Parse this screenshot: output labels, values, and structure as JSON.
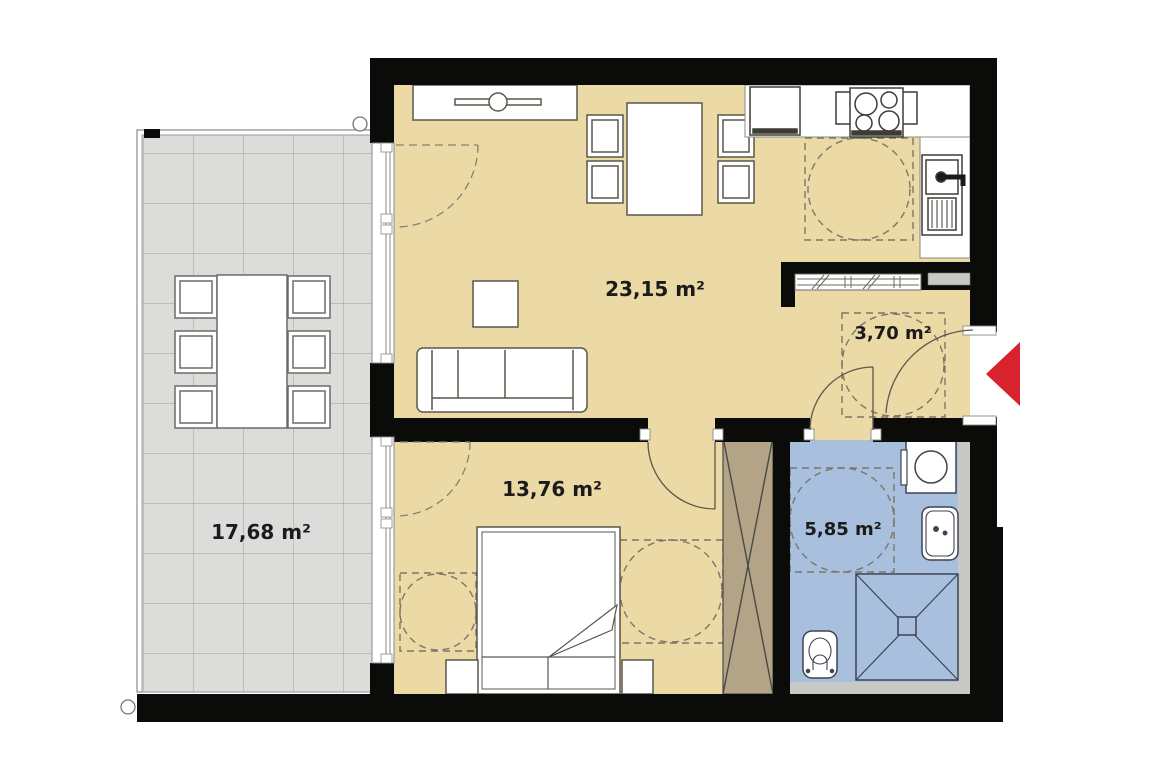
{
  "plan": {
    "type": "apartment-floor-plan",
    "unit_suffix": "m²",
    "rooms": [
      {
        "name": "living-room-kitchen",
        "label": "23,15 m²",
        "area": "23,15",
        "floor_color": "#EBD9A6"
      },
      {
        "name": "hallway",
        "label": "3,70 m²",
        "area": "3,70",
        "floor_color": "#EBD9A6"
      },
      {
        "name": "bedroom",
        "label": "13,76 m²",
        "area": "13,76",
        "floor_color": "#EBD9A6"
      },
      {
        "name": "bathroom",
        "label": "5,85 m²",
        "area": "5,85",
        "floor_color": "#A9BFDE"
      },
      {
        "name": "terrace",
        "label": "17,68 m²",
        "area": "17,68",
        "floor_color": "#DCDCDA"
      }
    ],
    "colors": {
      "walls": "#0B0B09",
      "floor_main": "#EBD9A6",
      "floor_bathroom": "#A9BFDE",
      "floor_terrace": "#DCDCDA",
      "wardrobe_fill": "#B3A488",
      "shaft_gray": "#C8C8C6",
      "entrance_arrow": "#D8232E"
    },
    "symbols": {
      "entrance": "red-arrow-pointing-left",
      "turning_circles_count": 5,
      "door_swings_count": 4
    },
    "furniture": [
      "closet-with-rod",
      "dining-table-4-chairs",
      "coffee-table",
      "sofa-3-seat",
      "fridge",
      "stove-4-burners",
      "kitchen-sink",
      "pass-through-window",
      "double-bed",
      "nightstand-left",
      "nightstand-right",
      "built-in-wardrobe-x",
      "washing-machine",
      "washbasin",
      "shower",
      "toilet",
      "terrace-table-6-chairs"
    ]
  }
}
